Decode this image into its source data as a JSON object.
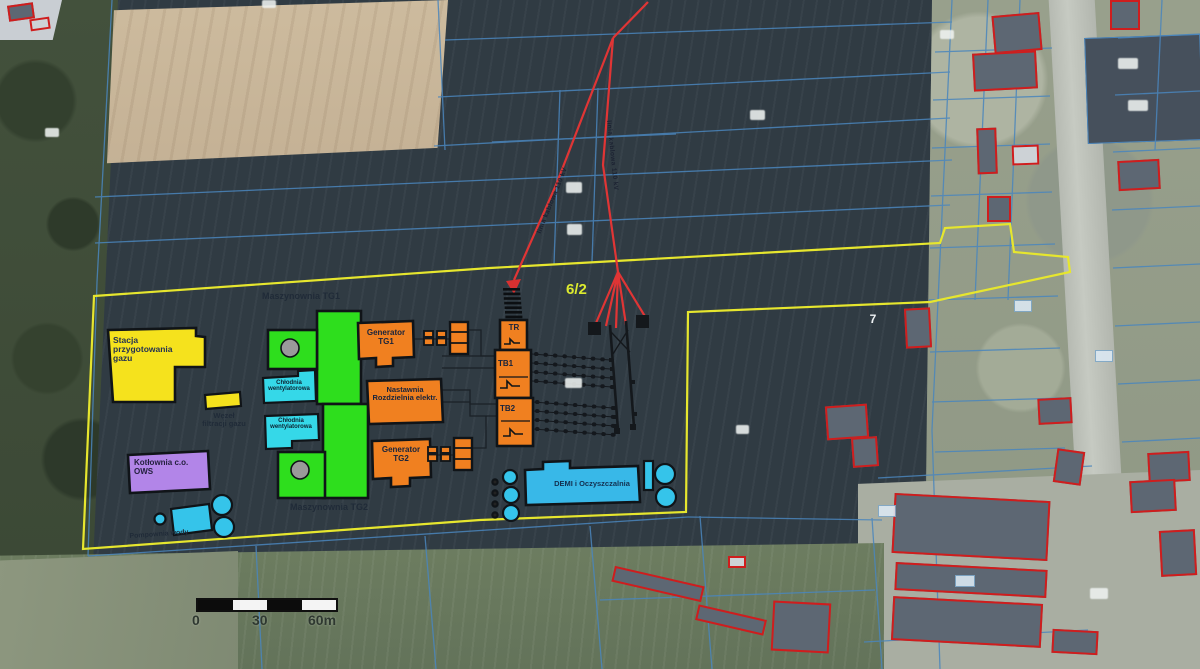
{
  "map": {
    "parcel_numbers": {
      "site": "6/2",
      "east": "7"
    },
    "scale_bar": {
      "ticks": [
        "0",
        "30",
        "60m"
      ]
    },
    "power_line_labels": {
      "left": "linia kablowa 110 kV",
      "right": "linia kablowa 110 kV"
    },
    "buildings": {
      "gas_prep": {
        "label": "Stacja przygotowania gazu"
      },
      "gas_filter": {
        "label": "Węzeł filtracji gazu"
      },
      "hall_tg1": {
        "label": "Maszynownia TG1"
      },
      "hall_tg2": {
        "label": "Maszynownia TG2"
      },
      "gen_tg1": {
        "label": "Generator TG1"
      },
      "gen_tg2": {
        "label": "Generator TG2"
      },
      "cooler_1": {
        "label": "Chłodnia wentylatorowa"
      },
      "cooler_2": {
        "label": "Chłodnia wentylatorowa"
      },
      "control": {
        "label": "Nastawnia Rozdzielnia elektr."
      },
      "boiler": {
        "label": "Kotłownia c.o. OWS"
      },
      "demi": {
        "label": "DEMI i Oczyszczalnia"
      },
      "pump": {
        "label": "Pompownia wody"
      },
      "tr": {
        "label": "TR"
      },
      "tb1": {
        "label": "TB1"
      },
      "tb2": {
        "label": "TB2"
      }
    },
    "colors": {
      "site_boundary": "#e6e62e",
      "gas_buildings": "#f5e21d",
      "machine_halls": "#2ede1d",
      "electrical_buildings": "#f08020",
      "water_buildings": "#38c0ea",
      "boiler_building": "#b285e8",
      "power_line": "#e03535",
      "cadastral_lines": "#4a86bd",
      "building_outline_photo": "#cf1d1d"
    }
  }
}
